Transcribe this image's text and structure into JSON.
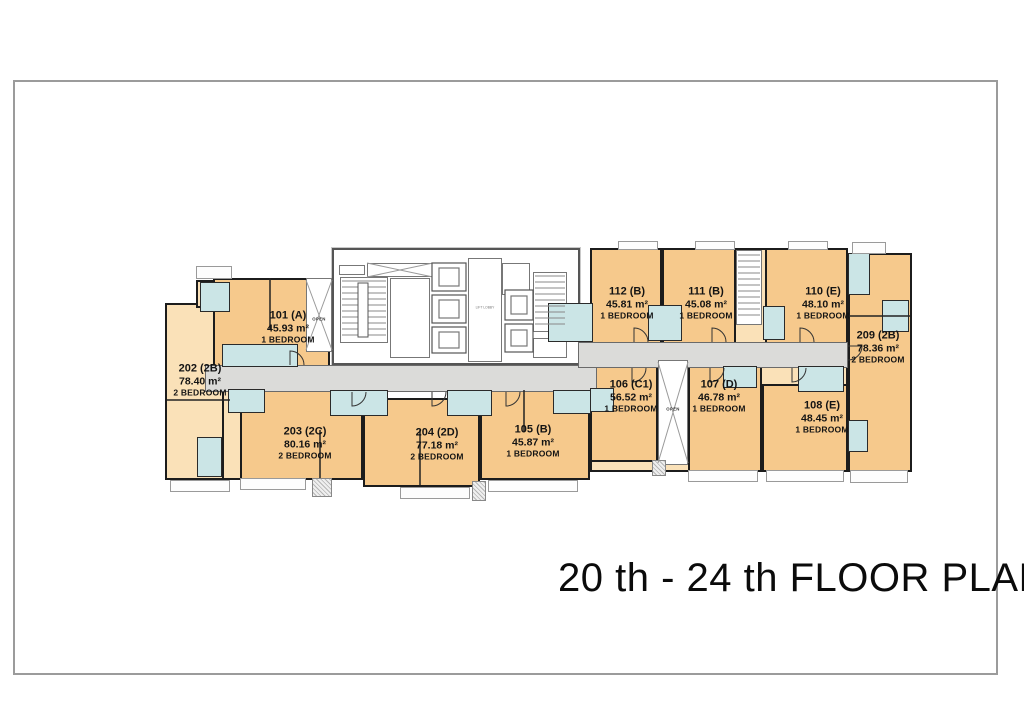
{
  "page": {
    "title": "20 th - 24 th FLOOR PLAN"
  },
  "plan": {
    "labels": {
      "open_left": "OPEN",
      "open_right": "OPEN",
      "lift_lobby": "LIFT LOBBY"
    },
    "units": {
      "u101": {
        "id": "101 (A)",
        "area": "45.93 m²",
        "bedrooms": "1 BEDROOM"
      },
      "u202": {
        "id": "202 (2B)",
        "area": "78.40 m²",
        "bedrooms": "2 BEDROOM"
      },
      "u203": {
        "id": "203 (2C)",
        "area": "80.16 m²",
        "bedrooms": "2 BEDROOM"
      },
      "u204": {
        "id": "204 (2D)",
        "area": "77.18 m²",
        "bedrooms": "2 BEDROOM"
      },
      "u105": {
        "id": "105 (B)",
        "area": "45.87 m²",
        "bedrooms": "1 BEDROOM"
      },
      "u106": {
        "id": "106 (C1)",
        "area": "56.52 m²",
        "bedrooms": "1 BEDROOM"
      },
      "u107": {
        "id": "107 (D)",
        "area": "46.78 m²",
        "bedrooms": "1 BEDROOM"
      },
      "u108": {
        "id": "108 (E)",
        "area": "48.45 m²",
        "bedrooms": "1 BEDROOM"
      },
      "u110": {
        "id": "110 (E)",
        "area": "48.10 m²",
        "bedrooms": "1 BEDROOM"
      },
      "u111": {
        "id": "111 (B)",
        "area": "45.08 m²",
        "bedrooms": "1 BEDROOM"
      },
      "u112": {
        "id": "112 (B)",
        "area": "45.81 m²",
        "bedrooms": "1 BEDROOM"
      },
      "u209": {
        "id": "209 (2B)",
        "area": "78.36 m²",
        "bedrooms": "2 BEDROOM"
      }
    },
    "colors": {
      "unit_orange": "#F6C98C",
      "unit_peach": "#FAE1B8",
      "bathroom_blue": "#CBE5E6",
      "corridor_gray": "#DBDBD9",
      "wall_black": "#1C1C1C",
      "frame_gray": "#9B9B9B"
    }
  }
}
